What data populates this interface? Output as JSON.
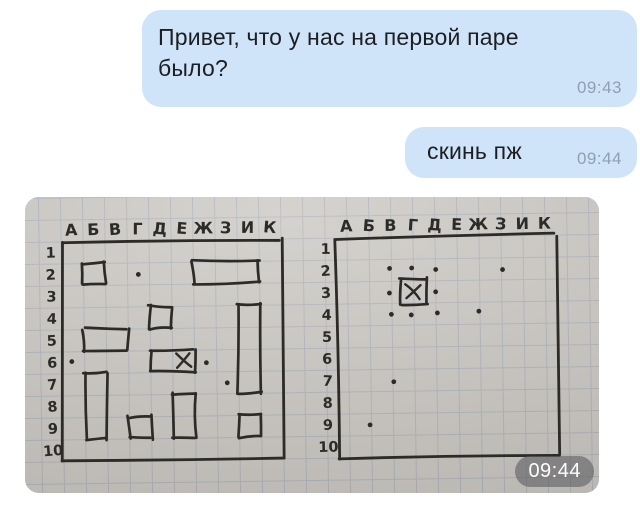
{
  "chat": {
    "background": "#ffffff",
    "bubble_color": "#cfe4f8",
    "text_color": "#1c1e22",
    "time_color": "#8fa0b0",
    "messages": [
      {
        "type": "text",
        "direction": "outgoing",
        "lines": [
          "Привет, что у нас на первой паре",
          "было?"
        ],
        "time": "09:43"
      },
      {
        "type": "text",
        "direction": "outgoing",
        "lines": [
          "скинь пж"
        ],
        "time": "09:44"
      },
      {
        "type": "photo",
        "direction": "outgoing",
        "time": "09:44",
        "description": "hand-drawn battleship (морской бой) grids on squared notebook paper"
      }
    ]
  },
  "photo": {
    "paper_color": "#cbc8c3",
    "grid_line_color": "#aeb3ba",
    "ink_color": "#2d2b28",
    "timestamp": "09:44",
    "column_labels": [
      "А",
      "Б",
      "В",
      "Г",
      "Д",
      "Е",
      "Ж",
      "З",
      "И",
      "К"
    ],
    "row_labels": [
      "1",
      "2",
      "3",
      "4",
      "5",
      "6",
      "7",
      "8",
      "9",
      "10"
    ],
    "left_grid": {
      "name": "own-fleet-grid",
      "ships": [
        {
          "col": 1,
          "row": 1,
          "w": 1,
          "h": 1
        },
        {
          "col": 6,
          "row": 1,
          "w": 3,
          "h": 1
        },
        {
          "col": 4,
          "row": 3,
          "w": 1,
          "h": 1
        },
        {
          "col": 8,
          "row": 3,
          "w": 1,
          "h": 4
        },
        {
          "col": 1,
          "row": 4,
          "w": 2,
          "h": 1
        },
        {
          "col": 4,
          "row": 5,
          "w": 2,
          "h": 1
        },
        {
          "col": 1,
          "row": 6,
          "w": 1,
          "h": 3
        },
        {
          "col": 5,
          "row": 7,
          "w": 1,
          "h": 2
        },
        {
          "col": 3,
          "row": 8,
          "w": 1,
          "h": 1
        },
        {
          "col": 8,
          "row": 8,
          "w": 1,
          "h": 1
        }
      ],
      "hits": [
        {
          "col": 5,
          "row": 5,
          "boxed": false
        }
      ],
      "dots": [
        {
          "col": 3,
          "row": 1
        },
        {
          "col": 0,
          "row": 5
        },
        {
          "col": 6,
          "row": 5
        },
        {
          "col": 7,
          "row": 6
        }
      ]
    },
    "right_grid": {
      "name": "opponent-tracking-grid",
      "ships": [],
      "hits": [
        {
          "col": 3,
          "row": 2,
          "boxed": true
        }
      ],
      "dots": [
        {
          "col": 2,
          "row": 1
        },
        {
          "col": 3,
          "row": 1
        },
        {
          "col": 4,
          "row": 1
        },
        {
          "col": 7,
          "row": 1
        },
        {
          "col": 2,
          "row": 2
        },
        {
          "col": 4,
          "row": 2
        },
        {
          "col": 2,
          "row": 3
        },
        {
          "col": 3,
          "row": 3
        },
        {
          "col": 4,
          "row": 3
        },
        {
          "col": 6,
          "row": 3
        },
        {
          "col": 2,
          "row": 6
        },
        {
          "col": 1,
          "row": 8
        }
      ]
    }
  }
}
